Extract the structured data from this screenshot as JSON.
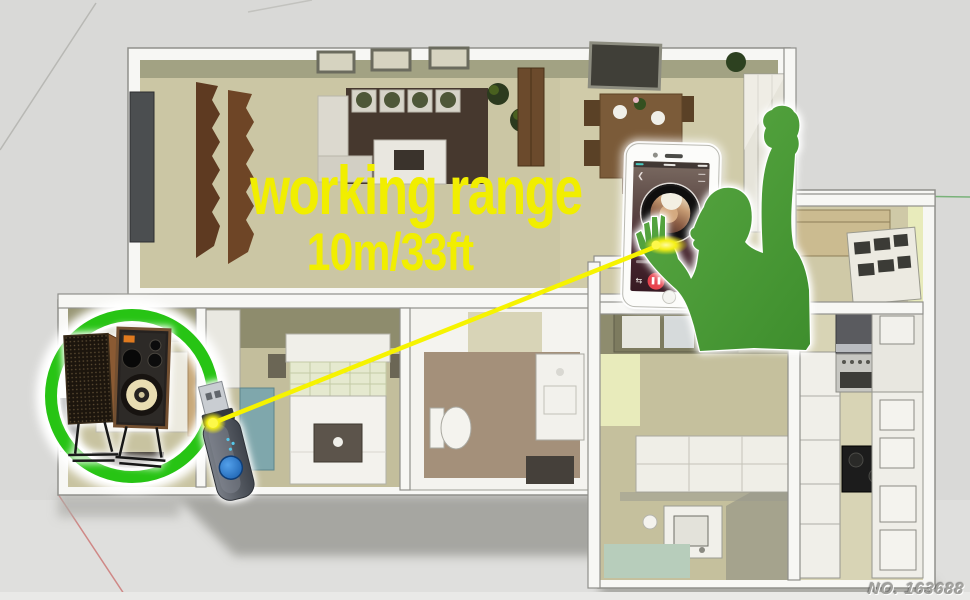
{
  "annotation": {
    "range_label": "working range",
    "range_value": "10m/33ft"
  },
  "footer": {
    "product_no": "NO. 163688"
  },
  "colors": {
    "accent-yellow": "#f1ee00",
    "ring-green": "#27c414",
    "person-green": "#58a742",
    "person-green-dark": "#3e8e2d",
    "dongle-blue": "#2b7fd4",
    "link-yellow": "#f6f300",
    "wall-white": "#f7f7f4",
    "wall-olive": "#a2a283",
    "floor-khaki": "#cbc6a4",
    "background-gray": "#d9d9d7"
  },
  "graphics": {
    "floor_plan": "apartment-3d-floor-plan",
    "ring": "range-highlight-circle",
    "speakers": "bookshelf-speakers",
    "dongle": "usb-bluetooth-receiver",
    "link": "wireless-connection-line",
    "phone": "smartphone-music-player",
    "person": "listener-silhouette"
  }
}
